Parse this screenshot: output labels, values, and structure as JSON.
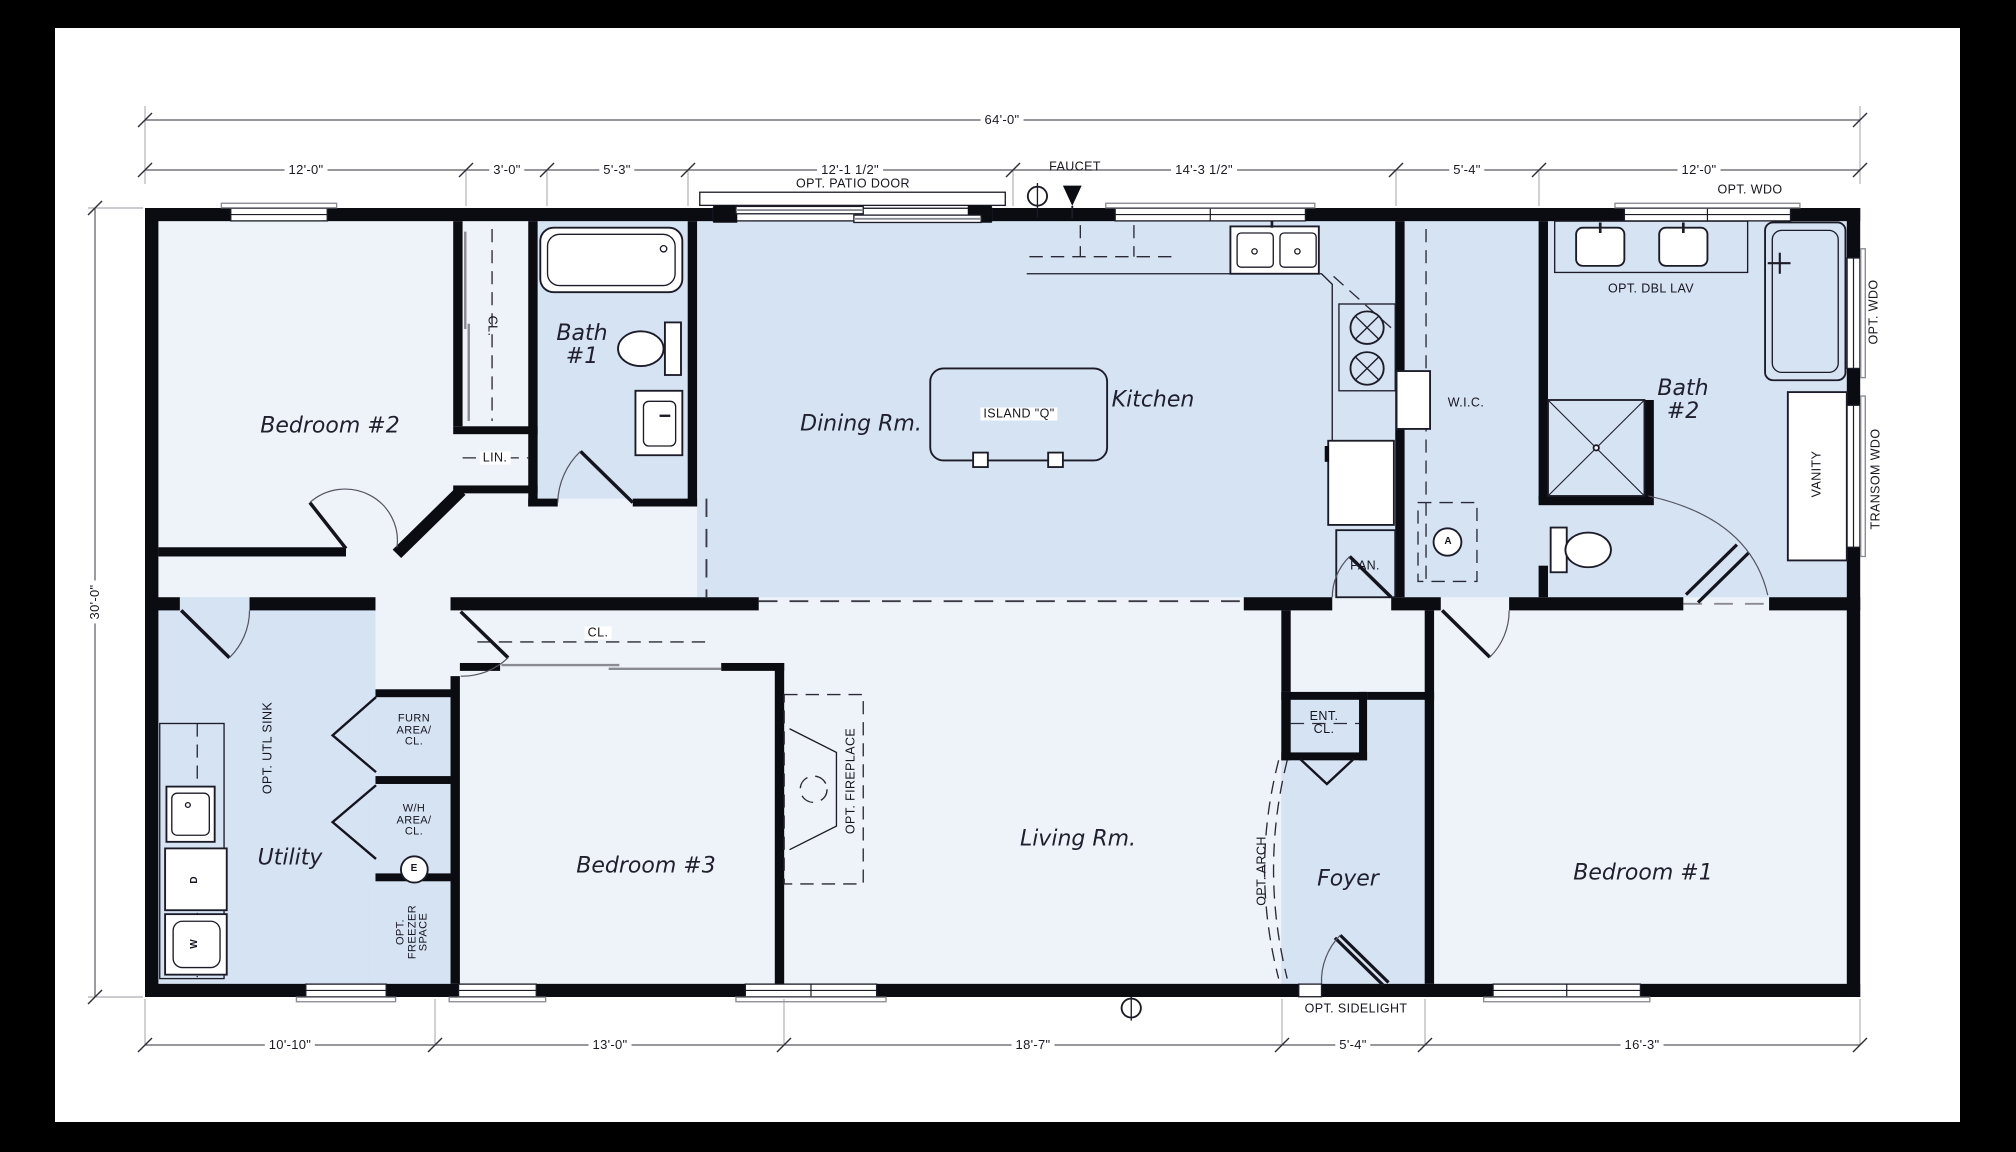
{
  "sheet": {
    "dimensions": {
      "overall_width": "64'-0\"",
      "overall_depth": "30'-0\"",
      "top_segments": [
        "12'-0\"",
        "3'-0\"",
        "5'-3\"",
        "12'-1 1/2\"",
        "14'-3 1/2\"",
        "5'-4\"",
        "12'-0\""
      ],
      "bottom_segments": [
        "10'-10\"",
        "13'-0\"",
        "18'-7\"",
        "5'-4\"",
        "16'-3\""
      ]
    },
    "rooms": {
      "bedroom2": "Bedroom #2",
      "bath1": "Bath\n#1",
      "dining": "Dining Rm.",
      "kitchen": "Kitchen",
      "island": "ISLAND \"Q\"",
      "wic": "W.I.C.",
      "bath2": "Bath\n#2",
      "utility": "Utility",
      "bedroom3": "Bedroom #3",
      "living": "Living Rm.",
      "foyer": "Foyer",
      "bedroom1": "Bedroom #1"
    },
    "labels": {
      "closet_bedroom2": "CL.",
      "linen": "LIN.",
      "closet_bedroom3": "CL.",
      "entry_closet": "ENT.\nCL.",
      "pantry": "PAN.",
      "opt_dbl_lav": "OPT. DBL LAV",
      "vanity": "VANITY",
      "transom_window": "TRANSOM WDO",
      "opt_window_top": "OPT. WDO",
      "opt_window_right": "OPT. WDO",
      "opt_patio_door": "OPT. PATIO DOOR",
      "faucet": "FAUCET",
      "furnace_area": "FURN\nAREA/\nCL.",
      "water_heater_area": "W/H\nAREA/\nCL.",
      "opt_freezer": "OPT.\nFREEZER\nSPACE",
      "opt_utility_sink": "OPT. UTL SINK",
      "opt_fireplace": "OPT. FIREPLACE",
      "opt_arch": "OPT. ARCH",
      "opt_sidelight": "OPT. SIDELIGHT"
    },
    "appliance_letters": {
      "washer": "W",
      "dryer": "D",
      "electrical": "E",
      "attic_access": "A"
    },
    "colors": {
      "wall": "#0b0b12",
      "room_light": "#eef3f9",
      "room_blue": "#d5e3f3",
      "page": "#000000"
    }
  }
}
